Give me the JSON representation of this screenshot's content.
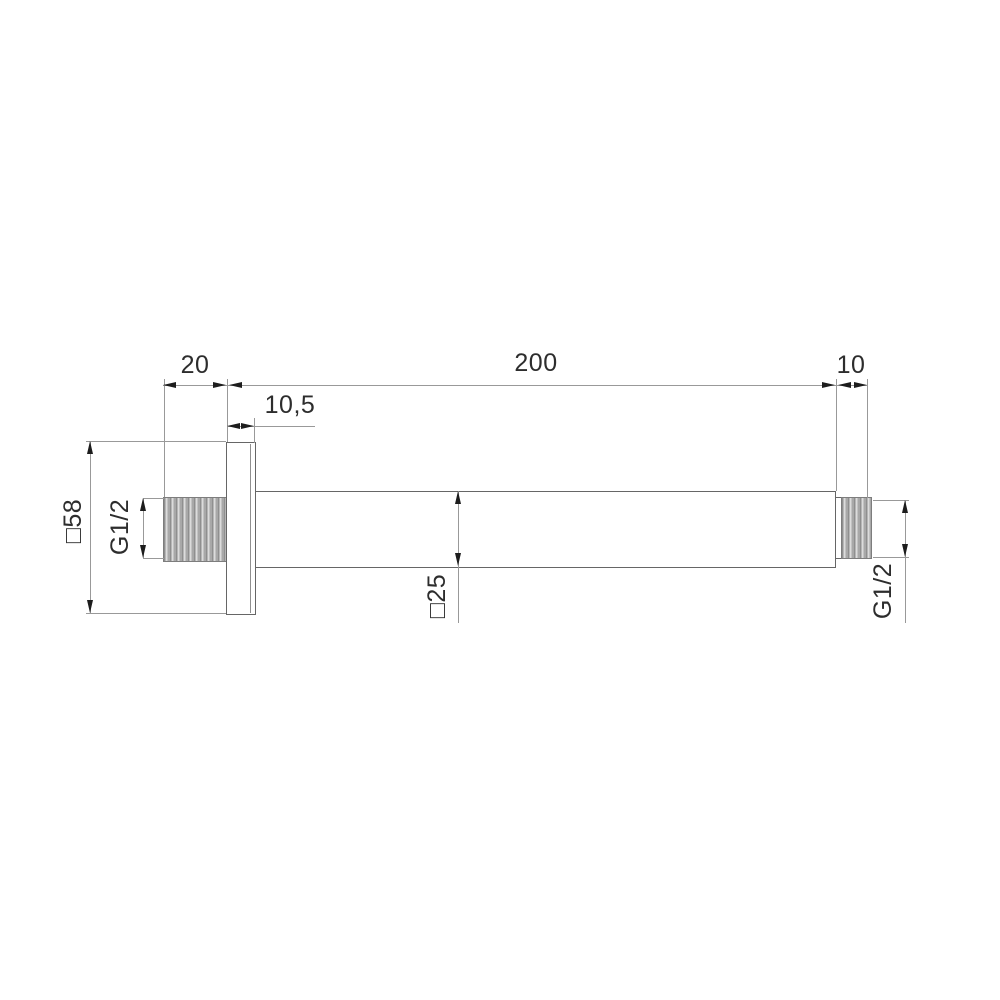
{
  "colors": {
    "background": "#ffffff",
    "part_outline": "#666666",
    "dimension_line": "#999999",
    "arrow": "#1d1d1d",
    "text": "#2d2d2d",
    "thread_fill": "#bcbcbc"
  },
  "dimensions": {
    "left_thread_length": "20",
    "arm_length": "200",
    "right_thread_length": "10",
    "flange_thickness": "10,5",
    "flange_square": "□58",
    "left_thread_spec": "G1/2",
    "tube_square": "□25",
    "right_thread_spec": "G1/2"
  }
}
